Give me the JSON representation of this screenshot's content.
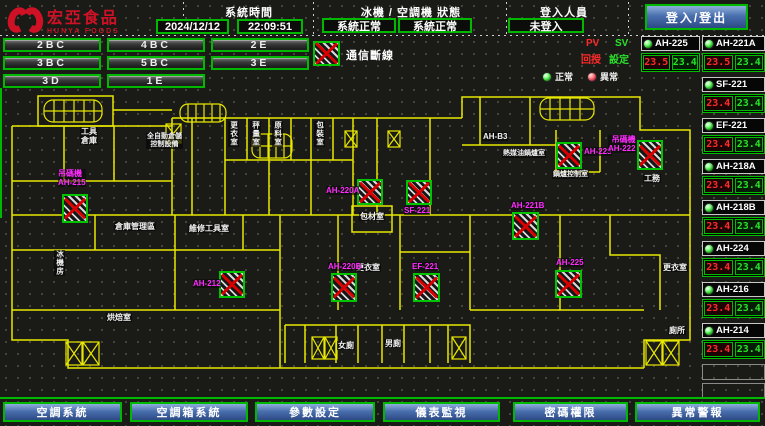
{
  "header": {
    "logo_title": "宏亞食品",
    "logo_subtitle": "HUNYA FOODS",
    "time_label": "系統時間",
    "date": "2024/12/12",
    "time": "22:09:51",
    "status_label": "冰機 / 空調機 狀態",
    "chiller_status": "系統正常",
    "ahu_status": "系統正常",
    "login_label": "登入人員",
    "login_status": "未登入",
    "login_button": "登入/登出"
  },
  "floors": {
    "buttons": [
      "2BC",
      "4BC",
      "2E",
      "3BC",
      "5BC",
      "3E",
      "3D",
      "1E"
    ]
  },
  "legend": {
    "comm_loss": "通信斷線",
    "pv": "PV",
    "sv": "SV",
    "pv_desc": "回授",
    "sv_desc": "設定",
    "normal": "正常",
    "abnormal": "異常"
  },
  "units_panel": {
    "featured": {
      "name": "AH-225",
      "pv": "23.5",
      "sv": "23.4"
    },
    "units": [
      {
        "name": "AH-221A",
        "pv": "23.5",
        "sv": "23.4"
      },
      {
        "name": "SF-221",
        "pv": "23.4",
        "sv": "23.4"
      },
      {
        "name": "EF-221",
        "pv": "23.4",
        "sv": "23.4"
      },
      {
        "name": "AH-218A",
        "pv": "23.4",
        "sv": "23.4"
      },
      {
        "name": "AH-218B",
        "pv": "23.4",
        "sv": "23.4"
      },
      {
        "name": "AH-224",
        "pv": "23.4",
        "sv": "23.4"
      },
      {
        "name": "AH-216",
        "pv": "23.4",
        "sv": "23.4"
      },
      {
        "name": "AH-214",
        "pv": "23.4",
        "sv": "23.4"
      }
    ]
  },
  "plan": {
    "markers": [
      {
        "line1": "吊碼機",
        "line2": "AH-215"
      },
      {
        "line1": "AH-220A"
      },
      {
        "line1": "SF-221"
      },
      {
        "line1": "AH-220B"
      },
      {
        "line1": "EF-221"
      },
      {
        "line1": "AH-225"
      },
      {
        "line1": "AH-221B"
      },
      {
        "line1": "AH-223"
      },
      {
        "line1": "吊碼機",
        "line2": "AH-222"
      },
      {
        "line1": "AH-212"
      }
    ],
    "rooms": [
      {
        "line1": "工具",
        "line2": "倉庫"
      },
      {
        "line1": "全自動倉儲",
        "line2": "控制設備"
      },
      {
        "line1": "更衣室"
      },
      {
        "line1": "秤量室"
      },
      {
        "line1": "原料室"
      },
      {
        "line1": "包裝室"
      },
      {
        "line1": "AH-B3"
      },
      {
        "line1": "熱媒油鍋爐室"
      },
      {
        "line1": "鍋爐控制室"
      },
      {
        "line1": "工務"
      },
      {
        "line1": "倉庫管理區"
      },
      {
        "line1": "維修工具室"
      },
      {
        "line1": "冰機房"
      },
      {
        "line1": "包材室"
      },
      {
        "line1": "更衣室"
      },
      {
        "line1": "女廁"
      },
      {
        "line1": "男廁"
      },
      {
        "line1": "更衣室"
      },
      {
        "line1": "廁所"
      },
      {
        "line1": "烘焙室"
      }
    ]
  },
  "nav": {
    "buttons": [
      "空調系統",
      "空調箱系統",
      "參數設定",
      "儀表監視",
      "密碼權限",
      "異常警報"
    ]
  },
  "colors": {
    "accent_green": "#00b800",
    "alarm_red": "#dd0000",
    "label_magenta": "#ff2bff",
    "wall_yellow": "#e8e800",
    "pv_red": "#ff2a2a",
    "sv_green": "#28e228",
    "nav_blue": "#4a6fae",
    "logo_red": "#cf1126"
  }
}
